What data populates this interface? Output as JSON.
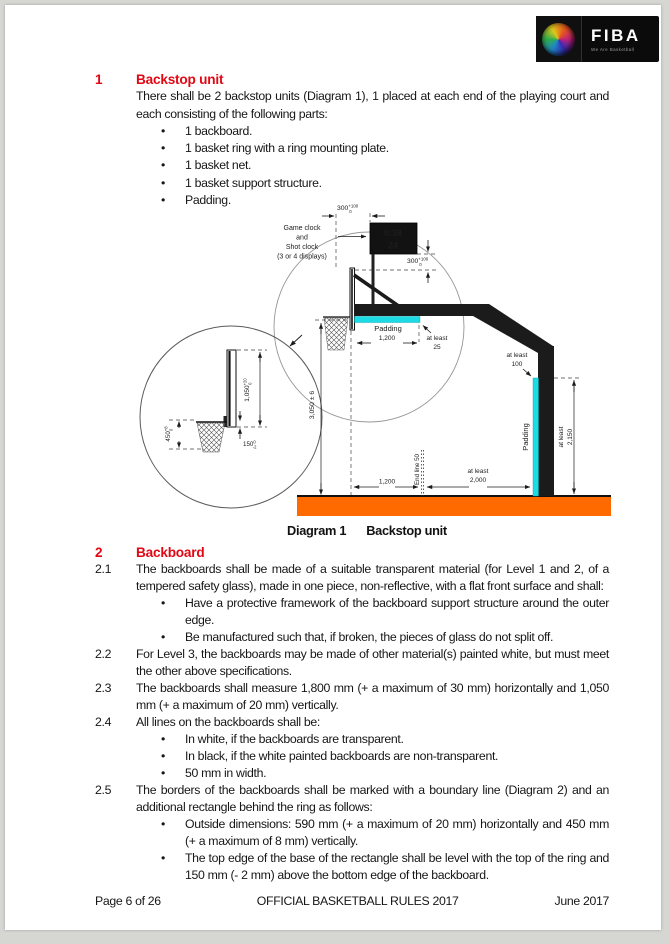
{
  "logo": {
    "brand": "FIBA",
    "tagline": "We Are Basketball"
  },
  "section1": {
    "number": "1",
    "title": "Backstop unit",
    "intro": "There shall be 2 backstop units (Diagram 1), 1 placed at each end of the playing court and each consisting of the following parts:",
    "bullets": [
      "1 backboard.",
      "1 basket ring with a ring mounting plate.",
      "1 basket net.",
      "1 basket support structure.",
      "Padding."
    ]
  },
  "diagram": {
    "caption_label": "Diagram 1",
    "caption_title": "Backstop unit",
    "clock_label_lines": [
      "Game clock",
      "and",
      "Shot clock",
      "(3 or 4 displays)"
    ],
    "game_clock": "0:38",
    "shot_clock": "24",
    "dim_top": {
      "v": "300",
      "sup": "+100",
      "sub": "0"
    },
    "dim_right": {
      "v": "300",
      "sup": "+100",
      "sub": "0"
    },
    "padding_arm": "Padding",
    "dim_arm": "1,200",
    "at_least_25": [
      "at least",
      "25"
    ],
    "at_least_100": [
      "at least",
      "100"
    ],
    "padding_pole": "Padding",
    "dim_pole": [
      "at least",
      "2,150"
    ],
    "dim_height": "3,050 ± 6",
    "end_line": "End line 50",
    "dim_floor1": "1,200",
    "dim_floor2": [
      "at least",
      "2,000"
    ],
    "inset": {
      "dim_board": {
        "v": "1,050",
        "sup": "+20",
        "sub": "0"
      },
      "dim_rect": {
        "v": "450",
        "sup": "+8",
        "sub": "0"
      },
      "dim_ring": {
        "v": "150",
        "sup": "0",
        "sub": "-2"
      }
    },
    "colors": {
      "padding": "#1bdce4",
      "floor": "#ff6a00",
      "structure": "#1b1b1b"
    }
  },
  "section2": {
    "number": "2",
    "title": "Backboard",
    "items": [
      {
        "number": "2.1",
        "text": "The backboards shall be made of a suitable transparent material (for Level 1 and 2, of a tempered safety glass), made in one piece, non-reflective, with a flat front surface and shall:",
        "bullets": [
          "Have a protective framework of the backboard support structure around the outer edge.",
          "Be manufactured such that, if broken, the pieces of glass do not split off."
        ]
      },
      {
        "number": "2.2",
        "text": "For Level 3, the backboards may be made of other material(s) painted white, but must meet the other above specifications."
      },
      {
        "number": "2.3",
        "text": "The backboards shall measure 1,800 mm (+ a maximum of 30 mm) horizontally and 1,050 mm (+ a maximum of 20 mm) vertically."
      },
      {
        "number": "2.4",
        "text": "All lines on the backboards shall be:",
        "bullets": [
          "In white, if the backboards are transparent.",
          "In black, if the white painted backboards are non-transparent.",
          "50 mm in width."
        ]
      },
      {
        "number": "2.5",
        "text": "The borders of the backboards shall be marked with a boundary line (Diagram 2) and an additional rectangle behind the ring as follows:",
        "bullets": [
          "Outside dimensions: 590 mm (+ a maximum of 20 mm) horizontally and 450 mm (+ a maximum of 8 mm) vertically.",
          "The top edge of the base of the rectangle shall be level with the top of the ring and 150 mm (- 2 mm) above the bottom edge of the backboard."
        ]
      }
    ]
  },
  "footer": {
    "left": "Page 6 of 26",
    "center": "OFFICIAL BASKETBALL RULES 2017",
    "right": "June 2017"
  }
}
